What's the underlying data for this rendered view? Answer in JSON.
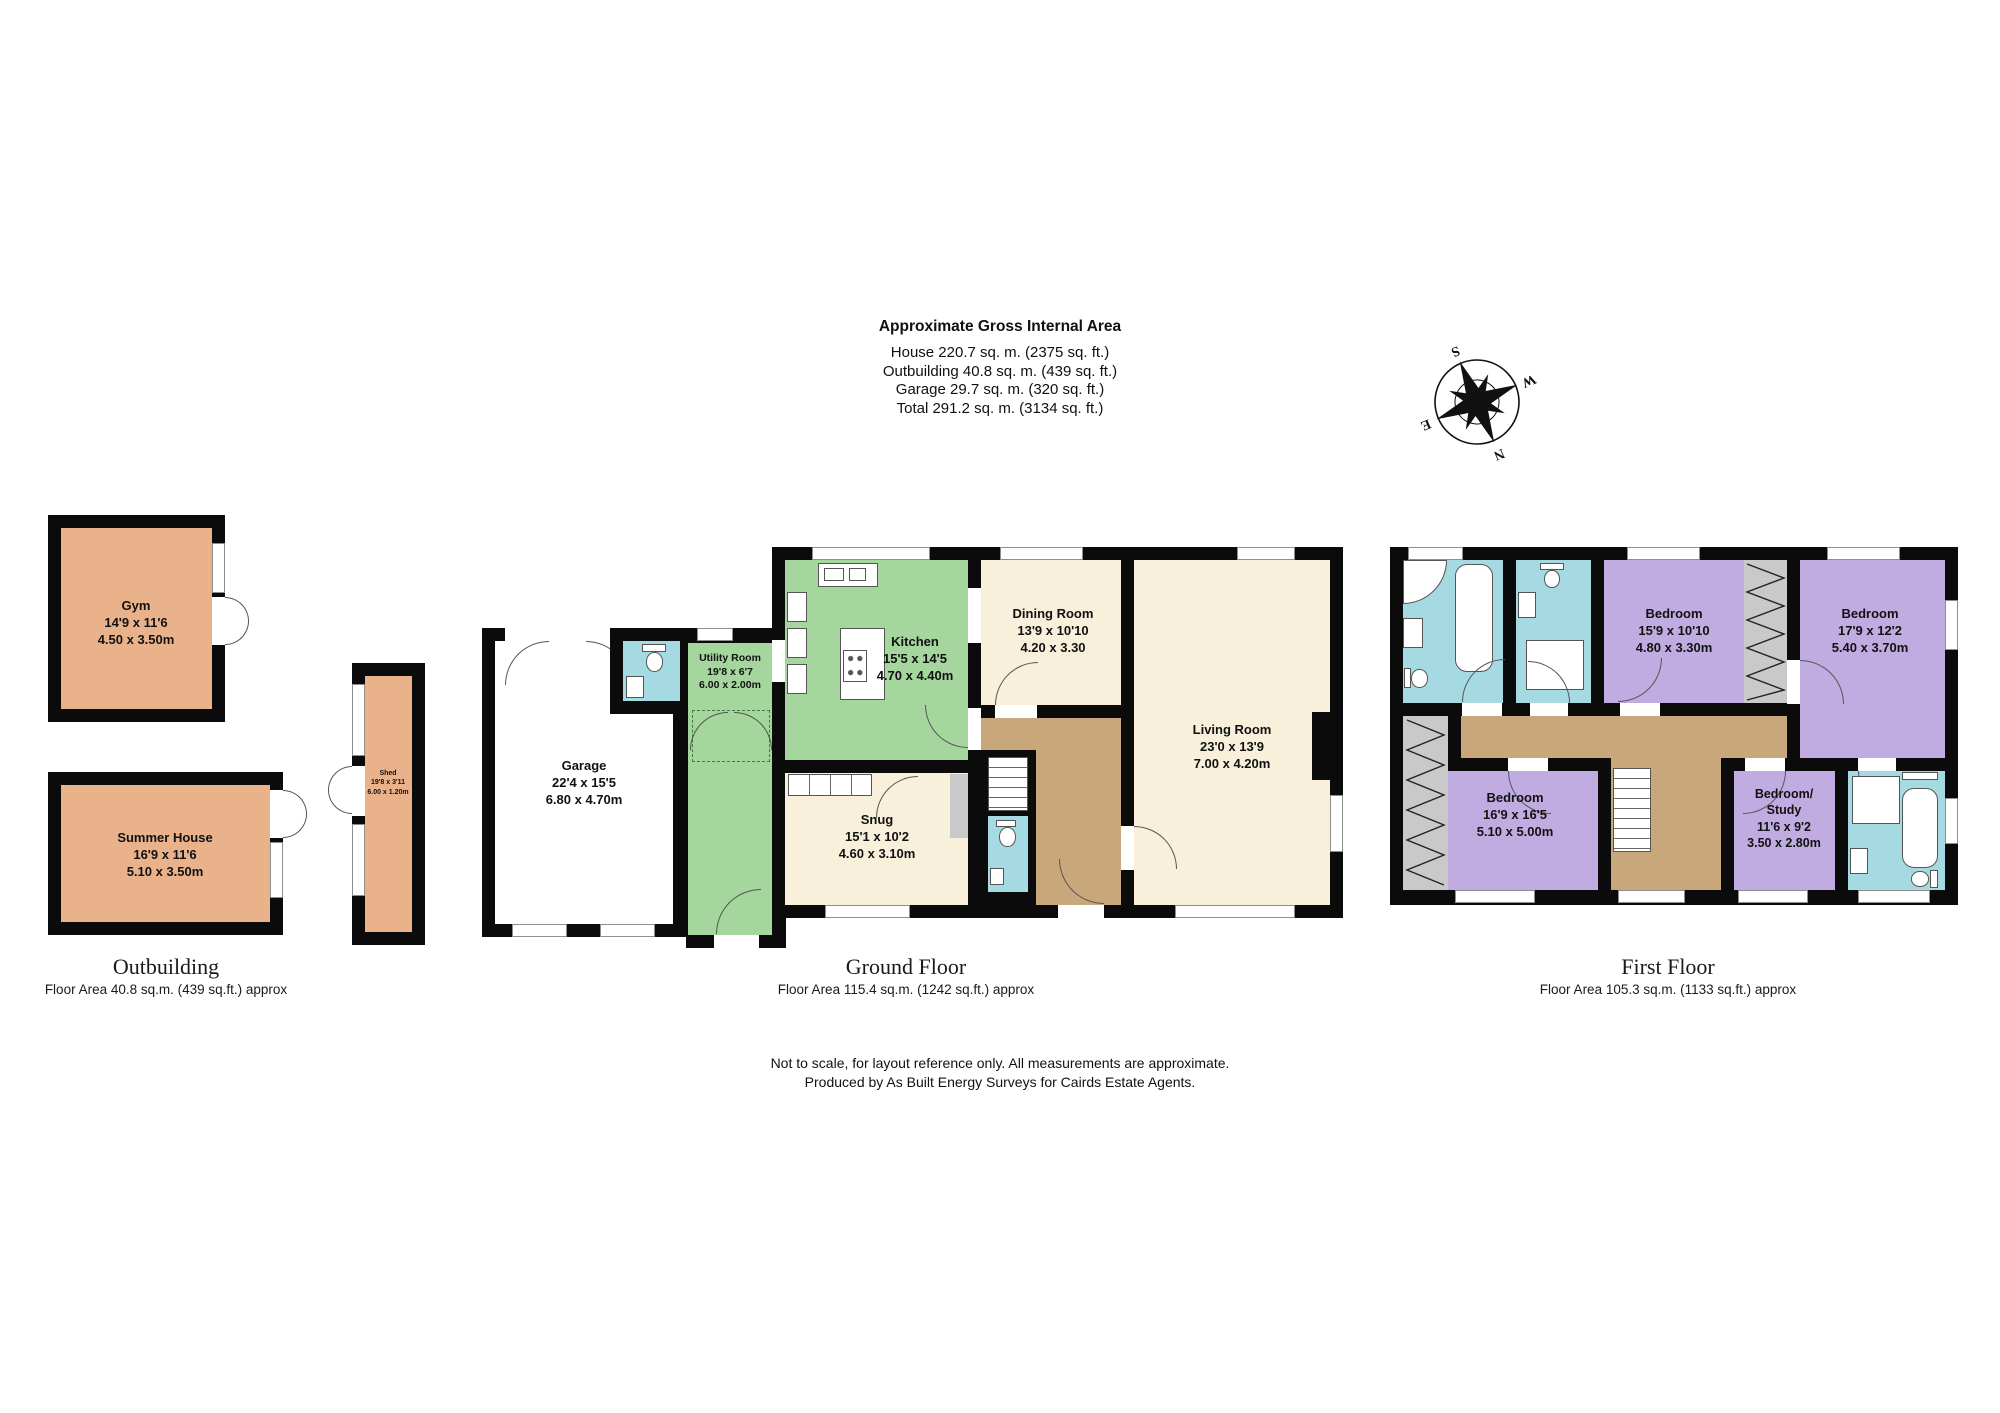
{
  "header": {
    "title": "Approximate Gross Internal Area",
    "house": "House 220.7 sq. m. (2375 sq. ft.)",
    "outbuilding": "Outbuilding 40.8 sq. m. (439 sq. ft.)",
    "garage": "Garage 29.7 sq. m. (320 sq. ft.)",
    "total": "Total 291.2 sq. m. (3134 sq. ft.)"
  },
  "compass": {
    "n": "N",
    "e": "E",
    "s": "S",
    "w": "W"
  },
  "rooms": {
    "gym": {
      "name": "Gym",
      "ft": "14'9 x 11'6",
      "m": "4.50 x 3.50m"
    },
    "summer_house": {
      "name": "Summer House",
      "ft": "16'9 x 11'6",
      "m": "5.10 x 3.50m"
    },
    "shed": {
      "name": "Shed",
      "ft": "19'8 x 3'11",
      "m": "6.00 x 1.20m"
    },
    "garage": {
      "name": "Garage",
      "ft": "22'4 x 15'5",
      "m": "6.80 x 4.70m"
    },
    "utility": {
      "name": "Utility Room",
      "ft": "19'8 x 6'7",
      "m": "6.00 x 2.00m"
    },
    "kitchen": {
      "name": "Kitchen",
      "ft": "15'5 x 14'5",
      "m": "4.70 x 4.40m"
    },
    "dining": {
      "name": "Dining Room",
      "ft": "13'9 x 10'10",
      "m": "4.20 x 3.30"
    },
    "living": {
      "name": "Living Room",
      "ft": "23'0 x 13'9",
      "m": "7.00 x 4.20m"
    },
    "snug": {
      "name": "Snug",
      "ft": "15'1 x 10'2",
      "m": "4.60 x 3.10m"
    },
    "bedroom1": {
      "name": "Bedroom",
      "ft": "15'9 x 10'10",
      "m": "4.80 x 3.30m"
    },
    "bedroom2": {
      "name": "Bedroom",
      "ft": "17'9 x 12'2",
      "m": "5.40 x 3.70m"
    },
    "bedroom3": {
      "name": "Bedroom",
      "ft": "16'9 x 16'5",
      "m": "5.10 x 5.00m"
    },
    "bedroom4": {
      "name1": "Bedroom/",
      "name2": "Study",
      "ft": "11'6 x 9'2",
      "m": "3.50 x 2.80m"
    }
  },
  "sections": {
    "outbuilding": {
      "label": "Outbuilding",
      "area": "Floor Area 40.8 sq.m. (439 sq.ft.) approx"
    },
    "ground": {
      "label": "Ground Floor",
      "area": "Floor Area 115.4 sq.m. (1242 sq.ft.) approx"
    },
    "first": {
      "label": "First Floor",
      "area": "Floor Area 105.3 sq.m. (1133 sq.ft.) approx"
    }
  },
  "footer": {
    "line1": "Not to scale, for layout reference only. All measurements are approximate.",
    "line2": "Produced by As Built Energy Surveys for Cairds Estate Agents."
  },
  "colors": {
    "outbuilding_fill": "#E9B28A",
    "kitchen_green": "#A5D69E",
    "room_cream": "#F8F0DB",
    "hall_brown": "#C8A87A",
    "bath_blue": "#A5DAE2",
    "bedroom_purple": "#C0ACE0",
    "wardrobe_gray": "#C9C9C9",
    "wall_black": "#0B0B0B"
  }
}
